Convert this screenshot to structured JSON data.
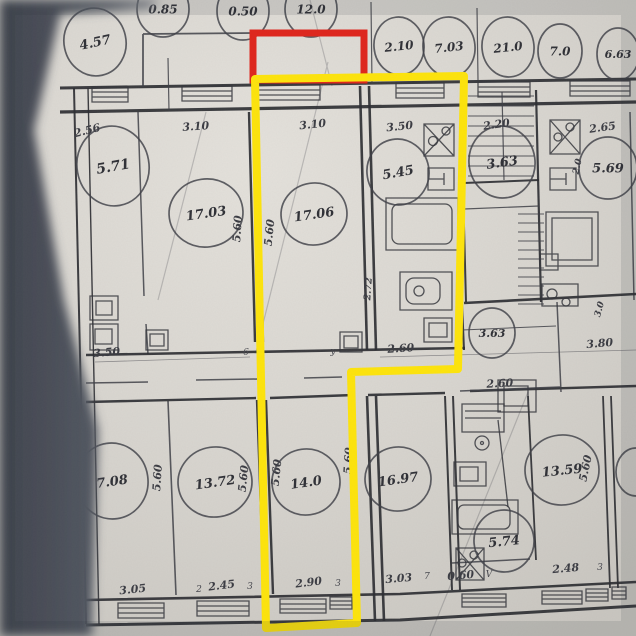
{
  "palette": {
    "paper": "#d7d4ce",
    "paper_light": "#e4e1db",
    "paper_dark": "#c7c4be",
    "ink": "#2e2f35",
    "shadow": "#474b55",
    "yellow": "#ffe50a",
    "red": "#e0241b"
  },
  "annotations": {
    "yellow_outline_points": "255,79 464,76 458,369 351,372 357,623 266,628",
    "red_box": {
      "x": 253,
      "y": 33,
      "w": 111,
      "h": 47
    }
  },
  "area_circles": [
    {
      "v": "0.85",
      "x": 163,
      "y": 9,
      "rx": 26,
      "ry": 28,
      "fs": 12,
      "rot": 0
    },
    {
      "v": "0.50",
      "x": 243,
      "y": 11,
      "rx": 26,
      "ry": 29,
      "fs": 12,
      "rot": 0
    },
    {
      "v": "12.0",
      "x": 311,
      "y": 9,
      "rx": 26,
      "ry": 28,
      "fs": 12,
      "rot": 0
    },
    {
      "v": "4.57",
      "x": 95,
      "y": 42,
      "rx": 31,
      "ry": 34,
      "fs": 13,
      "rot": -12
    },
    {
      "v": "2.10",
      "x": 399,
      "y": 46,
      "rx": 25,
      "ry": 29,
      "fs": 12,
      "rot": -6
    },
    {
      "v": "7.03",
      "x": 449,
      "y": 47,
      "rx": 26,
      "ry": 30,
      "fs": 12,
      "rot": -6
    },
    {
      "v": "21.0",
      "x": 508,
      "y": 47,
      "rx": 26,
      "ry": 30,
      "fs": 12,
      "rot": -6
    },
    {
      "v": "7.0",
      "x": 560,
      "y": 51,
      "rx": 22,
      "ry": 27,
      "fs": 12,
      "rot": 0
    },
    {
      "v": "6.63",
      "x": 618,
      "y": 54,
      "rx": 21,
      "ry": 26,
      "fs": 11,
      "rot": 0
    },
    {
      "v": "5.71",
      "x": 113,
      "y": 166,
      "rx": 36,
      "ry": 40,
      "fs": 14,
      "rot": -10
    },
    {
      "v": "17.03",
      "x": 206,
      "y": 213,
      "rx": 37,
      "ry": 34,
      "fs": 13,
      "rot": -8
    },
    {
      "v": "17.06",
      "x": 314,
      "y": 214,
      "rx": 33,
      "ry": 31,
      "fs": 13,
      "rot": -8
    },
    {
      "v": "5.45",
      "x": 398,
      "y": 172,
      "rx": 31,
      "ry": 33,
      "fs": 13,
      "rot": -10
    },
    {
      "v": "3.63",
      "x": 502,
      "y": 162,
      "rx": 33,
      "ry": 36,
      "fs": 13,
      "rot": -8
    },
    {
      "v": "5.69",
      "x": 608,
      "y": 168,
      "rx": 29,
      "ry": 31,
      "fs": 13,
      "rot": 0
    },
    {
      "v": "3.63",
      "x": 492,
      "y": 333,
      "rx": 23,
      "ry": 25,
      "fs": 11,
      "rot": 0
    },
    {
      "v": "7.08",
      "x": 112,
      "y": 481,
      "rx": 36,
      "ry": 38,
      "fs": 13,
      "rot": -8
    },
    {
      "v": "13.72",
      "x": 215,
      "y": 482,
      "rx": 37,
      "ry": 35,
      "fs": 13,
      "rot": -8
    },
    {
      "v": "14.0",
      "x": 306,
      "y": 482,
      "rx": 34,
      "ry": 33,
      "fs": 13,
      "rot": -8
    },
    {
      "v": "16.97",
      "x": 398,
      "y": 479,
      "rx": 33,
      "ry": 32,
      "fs": 13,
      "rot": -8
    },
    {
      "v": "13.59",
      "x": 562,
      "y": 470,
      "rx": 37,
      "ry": 35,
      "fs": 13,
      "rot": -6
    },
    {
      "v": "5.74",
      "x": 504,
      "y": 541,
      "rx": 30,
      "ry": 31,
      "fs": 13,
      "rot": -6
    },
    {
      "v": "",
      "x": 636,
      "y": 472,
      "rx": 20,
      "ry": 24,
      "fs": 11,
      "rot": 0
    }
  ],
  "dimensions": [
    {
      "t": "2.56",
      "x": 88,
      "y": 134,
      "rot": -14,
      "fs": 11
    },
    {
      "t": "3.10",
      "x": 196,
      "y": 130,
      "rot": -4,
      "fs": 11
    },
    {
      "t": "3.10",
      "x": 313,
      "y": 128,
      "rot": -6,
      "fs": 11
    },
    {
      "t": "3.50",
      "x": 400,
      "y": 130,
      "rot": -6,
      "fs": 11
    },
    {
      "t": "2.20",
      "x": 497,
      "y": 128,
      "rot": -8,
      "fs": 11
    },
    {
      "t": "2.65",
      "x": 603,
      "y": 131,
      "rot": -8,
      "fs": 11
    },
    {
      "t": "5.60",
      "x": 241,
      "y": 229,
      "rot": -86,
      "fs": 11
    },
    {
      "t": "5.60",
      "x": 273,
      "y": 233,
      "rot": -84,
      "fs": 11
    },
    {
      "t": "2.72",
      "x": 371,
      "y": 289,
      "rot": -86,
      "fs": 9.5
    },
    {
      "t": "2.0",
      "x": 580,
      "y": 167,
      "rot": -78,
      "fs": 9
    },
    {
      "t": "3.0",
      "x": 602,
      "y": 310,
      "rot": -74,
      "fs": 9
    },
    {
      "t": "3.50",
      "x": 107,
      "y": 356,
      "rot": -5,
      "fs": 11
    },
    {
      "t": "2.60",
      "x": 401,
      "y": 352,
      "rot": -4,
      "fs": 11
    },
    {
      "t": "3.80",
      "x": 600,
      "y": 347,
      "rot": -5,
      "fs": 11
    },
    {
      "t": "2.60",
      "x": 500,
      "y": 387,
      "rot": -3,
      "fs": 11
    },
    {
      "t": "5.60",
      "x": 161,
      "y": 478,
      "rot": -86,
      "fs": 11
    },
    {
      "t": "5.60",
      "x": 247,
      "y": 479,
      "rot": -84,
      "fs": 11
    },
    {
      "t": "5.60",
      "x": 280,
      "y": 473,
      "rot": -84,
      "fs": 11
    },
    {
      "t": "5.60",
      "x": 352,
      "y": 461,
      "rot": -86,
      "fs": 11
    },
    {
      "t": "5.60",
      "x": 589,
      "y": 469,
      "rot": -78,
      "fs": 11
    },
    {
      "t": "3.05",
      "x": 133,
      "y": 593,
      "rot": -6,
      "fs": 11
    },
    {
      "t": "2.45",
      "x": 222,
      "y": 589,
      "rot": -7,
      "fs": 11
    },
    {
      "t": "2.90",
      "x": 309,
      "y": 586,
      "rot": -7,
      "fs": 11
    },
    {
      "t": "3.03",
      "x": 399,
      "y": 582,
      "rot": -5,
      "fs": 11
    },
    {
      "t": "0.60",
      "x": 461,
      "y": 579,
      "rot": -5,
      "fs": 11
    },
    {
      "t": "2.48",
      "x": 566,
      "y": 572,
      "rot": -5,
      "fs": 11
    }
  ],
  "tags": [
    {
      "t": "2",
      "x": 199,
      "y": 592
    },
    {
      "t": "3",
      "x": 250,
      "y": 589
    },
    {
      "t": "3",
      "x": 338,
      "y": 586
    },
    {
      "t": "7",
      "x": 427,
      "y": 579
    },
    {
      "t": "V",
      "x": 489,
      "y": 577
    },
    {
      "t": "3",
      "x": 600,
      "y": 570
    },
    {
      "t": "6",
      "x": 246,
      "y": 355
    },
    {
      "t": "y",
      "x": 333,
      "y": 354
    }
  ]
}
